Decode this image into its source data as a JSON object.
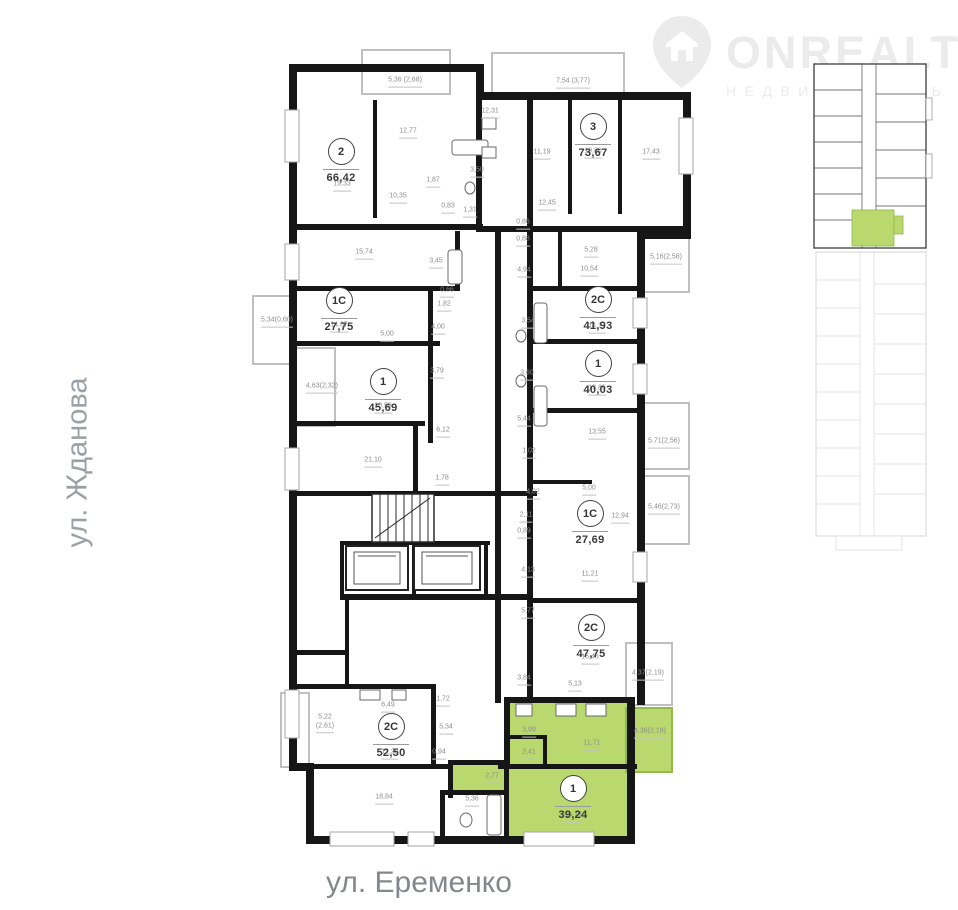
{
  "logo": {
    "brand": "ONREALT",
    "tagline": "НЕДВИЖИМОСТЬ",
    "color": "#ebebeb"
  },
  "streets": {
    "left": "ул. Жданова",
    "bottom": "ул. Еременко"
  },
  "plan": {
    "highlight_color": "#b9d86e",
    "highlight_border": "#94bb4a",
    "wall_color": "#161616",
    "units": [
      {
        "id": "2",
        "area": "66,42",
        "x": 341,
        "y": 152
      },
      {
        "id": "3",
        "area": "73,67",
        "x": 593,
        "y": 127
      },
      {
        "id": "1С",
        "area": "27,75",
        "x": 339,
        "y": 301
      },
      {
        "id": "1",
        "area": "45,69",
        "x": 383,
        "y": 382
      },
      {
        "id": "2С",
        "area": "41,93",
        "x": 598,
        "y": 300
      },
      {
        "id": "1",
        "area": "40,03",
        "x": 598,
        "y": 364
      },
      {
        "id": "1С",
        "area": "27,69",
        "x": 590,
        "y": 514
      },
      {
        "id": "2С",
        "area": "47,75",
        "x": 591,
        "y": 628
      },
      {
        "id": "2С",
        "area": "52,50",
        "x": 391,
        "y": 727
      },
      {
        "id": "1",
        "area": "39,24",
        "x": 573,
        "y": 789,
        "highlight": true
      }
    ],
    "room_labels": [
      {
        "t": "5,36 (2,68)",
        "x": 405,
        "y": 82
      },
      {
        "t": "12,77",
        "x": 408,
        "y": 133
      },
      {
        "t": "12,31",
        "x": 490,
        "y": 113
      },
      {
        "t": "19,33",
        "x": 342,
        "y": 186
      },
      {
        "t": "10,35",
        "x": 398,
        "y": 198
      },
      {
        "t": "1,87",
        "x": 433,
        "y": 182
      },
      {
        "t": "3,50",
        "x": 477,
        "y": 172
      },
      {
        "t": "0,83",
        "x": 448,
        "y": 208
      },
      {
        "t": "1,31",
        "x": 470,
        "y": 212
      },
      {
        "t": "7,54 (3,77)",
        "x": 573,
        "y": 83
      },
      {
        "t": "11,19",
        "x": 542,
        "y": 154
      },
      {
        "t": "10,86",
        "x": 593,
        "y": 153
      },
      {
        "t": "17,43",
        "x": 651,
        "y": 154
      },
      {
        "t": "12,45",
        "x": 547,
        "y": 205
      },
      {
        "t": "0,86",
        "x": 523,
        "y": 224
      },
      {
        "t": "0,88",
        "x": 523,
        "y": 241
      },
      {
        "t": "15,74",
        "x": 364,
        "y": 254
      },
      {
        "t": "3,45",
        "x": 436,
        "y": 263
      },
      {
        "t": "0,66",
        "x": 447,
        "y": 292
      },
      {
        "t": "1,82",
        "x": 444,
        "y": 306
      },
      {
        "t": "5,34(0,60)",
        "x": 277,
        "y": 322
      },
      {
        "t": "14,67",
        "x": 339,
        "y": 327
      },
      {
        "t": "5,00",
        "x": 387,
        "y": 336
      },
      {
        "t": "4,00",
        "x": 438,
        "y": 329
      },
      {
        "t": "3,79",
        "x": 437,
        "y": 373
      },
      {
        "t": "4,63(2,32)",
        "x": 322,
        "y": 388
      },
      {
        "t": "10,58",
        "x": 383,
        "y": 408
      },
      {
        "t": "6,12",
        "x": 443,
        "y": 432
      },
      {
        "t": "21,10",
        "x": 373,
        "y": 462
      },
      {
        "t": "1,78",
        "x": 442,
        "y": 480
      },
      {
        "t": "4,94",
        "x": 524,
        "y": 272
      },
      {
        "t": "5,28",
        "x": 591,
        "y": 252
      },
      {
        "t": "10,54",
        "x": 589,
        "y": 271
      },
      {
        "t": "5,16(2,58)",
        "x": 666,
        "y": 259
      },
      {
        "t": "3,54",
        "x": 528,
        "y": 323
      },
      {
        "t": "14,17",
        "x": 597,
        "y": 328
      },
      {
        "t": "3,60",
        "x": 527,
        "y": 375
      },
      {
        "t": "13,86",
        "x": 597,
        "y": 390
      },
      {
        "t": "5,44",
        "x": 524,
        "y": 421
      },
      {
        "t": "13,55",
        "x": 597,
        "y": 434
      },
      {
        "t": "1,02",
        "x": 529,
        "y": 453
      },
      {
        "t": "5,71(2,56)",
        "x": 664,
        "y": 443
      },
      {
        "t": "4,02",
        "x": 533,
        "y": 494
      },
      {
        "t": "5,00",
        "x": 589,
        "y": 490
      },
      {
        "t": "12,94",
        "x": 620,
        "y": 518
      },
      {
        "t": "5,46(2,73)",
        "x": 664,
        "y": 509
      },
      {
        "t": "2,11",
        "x": 526,
        "y": 517
      },
      {
        "t": "0,89",
        "x": 524,
        "y": 533
      },
      {
        "t": "4,13",
        "x": 528,
        "y": 572
      },
      {
        "t": "11,21",
        "x": 590,
        "y": 576
      },
      {
        "t": "5,77",
        "x": 528,
        "y": 613
      },
      {
        "t": "15,48",
        "x": 590,
        "y": 659
      },
      {
        "t": "3,84",
        "x": 524,
        "y": 680
      },
      {
        "t": "5,13",
        "x": 575,
        "y": 686
      },
      {
        "t": "4,37(2,19)",
        "x": 648,
        "y": 675
      },
      {
        "t": "6,49",
        "x": 388,
        "y": 707
      },
      {
        "t": "1,72",
        "x": 443,
        "y": 701
      },
      {
        "t": "5,34",
        "x": 446,
        "y": 729
      },
      {
        "t": "0,94",
        "x": 439,
        "y": 754
      },
      {
        "t": "5,22\n(2,61)",
        "x": 325,
        "y": 723
      },
      {
        "t": "11,20",
        "x": 390,
        "y": 754
      },
      {
        "t": "18,84",
        "x": 384,
        "y": 799
      },
      {
        "t": "5,36",
        "x": 472,
        "y": 801
      },
      {
        "t": "3,99",
        "x": 529,
        "y": 732
      },
      {
        "t": "11,71",
        "x": 592,
        "y": 745
      },
      {
        "t": "2,41",
        "x": 529,
        "y": 754
      },
      {
        "t": "2,77",
        "x": 492,
        "y": 778
      },
      {
        "t": "16,78",
        "x": 573,
        "y": 817
      },
      {
        "t": "4,36(2,18)",
        "x": 650,
        "y": 733
      }
    ]
  }
}
